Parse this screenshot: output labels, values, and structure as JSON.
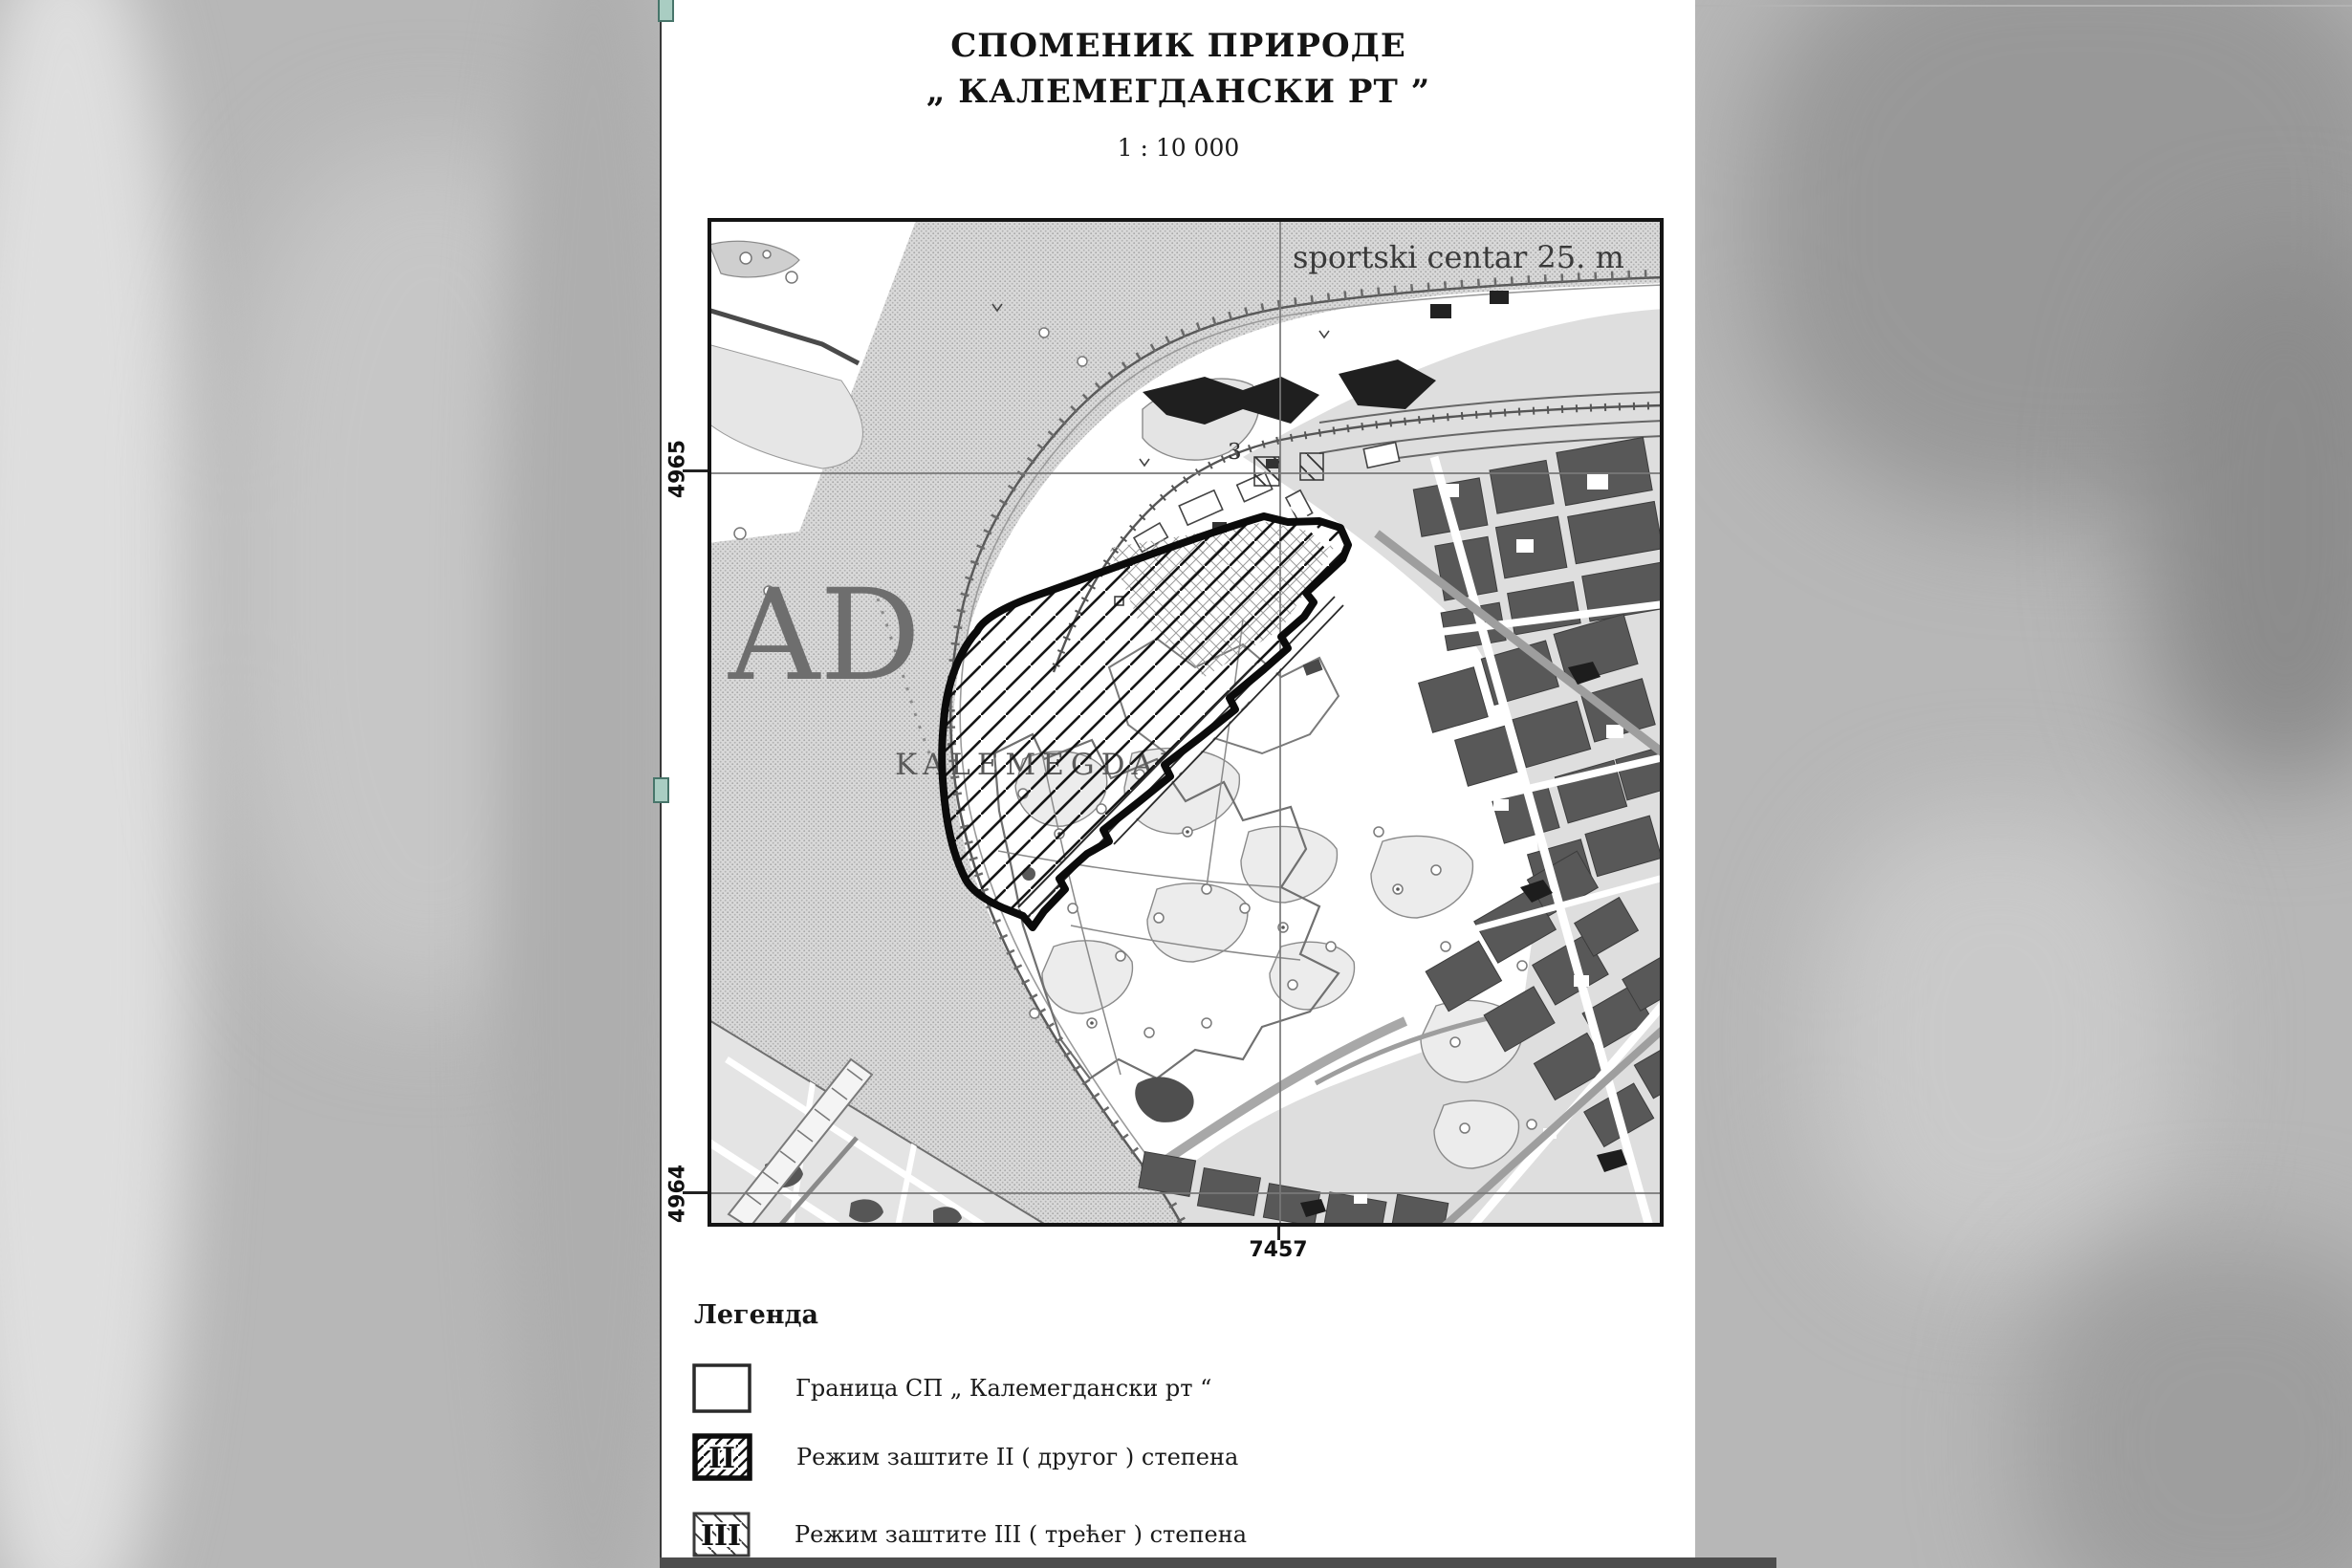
{
  "document": {
    "title_line1": "СПОМЕНИК ПРИРОДЕ",
    "title_line2": "„ КАЛЕМЕГДАНСКИ РТ ”",
    "scale_label": "1 : 10 000"
  },
  "map": {
    "place_labels": {
      "sportski_centar": "sportski centar 25. m",
      "big_letters": "AD",
      "kalemegdan": "KALEMEGDAN",
      "road_number": "3"
    },
    "grid_labels": {
      "northing_top": "4965",
      "northing_bottom": "4964",
      "easting": "7457"
    }
  },
  "legend": {
    "heading": "Легенда",
    "items": [
      {
        "symbol": "boundary-box",
        "roman": "",
        "label": "Граница СП „ Калемегдански рт “"
      },
      {
        "symbol": "regime-2-box",
        "roman": "II",
        "label": "Режим заштите II ( другог ) степена"
      },
      {
        "symbol": "regime-3-box",
        "roman": "III",
        "label": "Режим заштите III ( трећег ) степена"
      }
    ]
  },
  "colors": {
    "paper": "#ffffff",
    "ink": "#141414",
    "water_halftone": "#c6c6c6",
    "urban_block": "#585858",
    "boundary_black": "#0b0b0b",
    "handle_teal": "#a9cdc2"
  }
}
